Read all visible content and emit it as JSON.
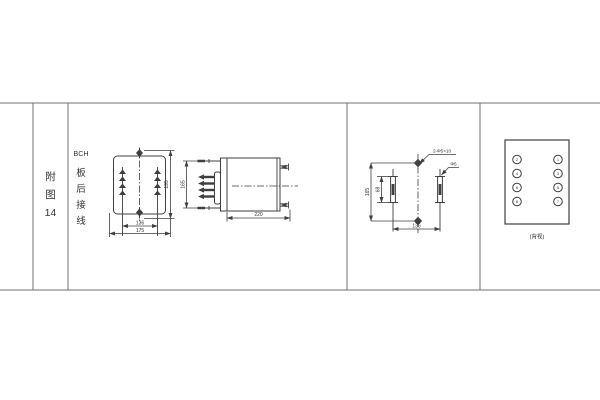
{
  "table": {
    "col1": [
      "附",
      "图",
      "14"
    ],
    "col2": [
      "BCH",
      "板",
      "后",
      "接",
      "线"
    ]
  },
  "front_view": {
    "height": "195",
    "inner_width": "136",
    "outer_width": "175"
  },
  "side_view": {
    "terminal_height": "165",
    "depth": "220"
  },
  "drill_plan": {
    "height": "165",
    "slot_length": "68",
    "slot_spacing": "136",
    "holes_note": "2-Φ5×10",
    "slot_note": "Φ5"
  },
  "terminal_view": {
    "left": [
      "2",
      "4",
      "6",
      "8"
    ],
    "right": [
      "1",
      "3",
      "5",
      "7"
    ],
    "caption": "(背视)"
  },
  "colors": {
    "line": "#3f3f3f",
    "grid": "#707070",
    "text": "#333333",
    "background": "#ffffff"
  }
}
